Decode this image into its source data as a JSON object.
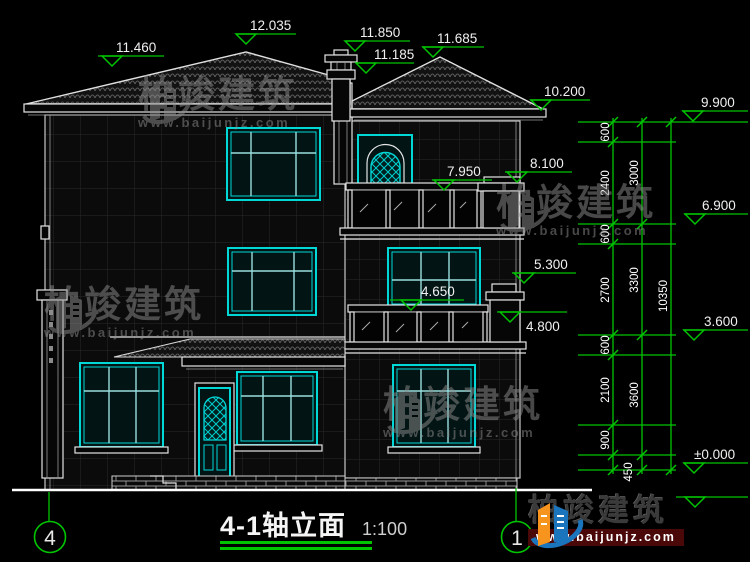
{
  "drawing": {
    "title_block": {
      "title": "4-1轴立面",
      "scale": "1:100"
    },
    "axis_markers": {
      "left": "4",
      "right": "1"
    },
    "elevations": [
      "11.460",
      "12.035",
      "11.850",
      "11.685",
      "11.185",
      "10.200",
      "9.900",
      "6.900",
      "3.600",
      "±0.000",
      "7.950",
      "8.100",
      "5.300",
      "4.650",
      "4.800"
    ],
    "dimensions": {
      "inner_chain": [
        "600",
        "2400",
        "600",
        "2700",
        "600",
        "2100",
        "900"
      ],
      "middle_chain": [
        "3000",
        "3300",
        "3600"
      ],
      "bottom_segment": "450",
      "total": "10350"
    },
    "colors": {
      "dimension_green": "#00c400",
      "window_cyan": "#00d8d8",
      "line_white": "#e4e4e4",
      "background": "#000000"
    }
  },
  "watermark": {
    "brand": "柏竣建筑",
    "url": "www.baijunjz.com"
  },
  "footer_logo": {
    "brand": "柏竣建筑",
    "url": "www.baijunjz.com"
  }
}
